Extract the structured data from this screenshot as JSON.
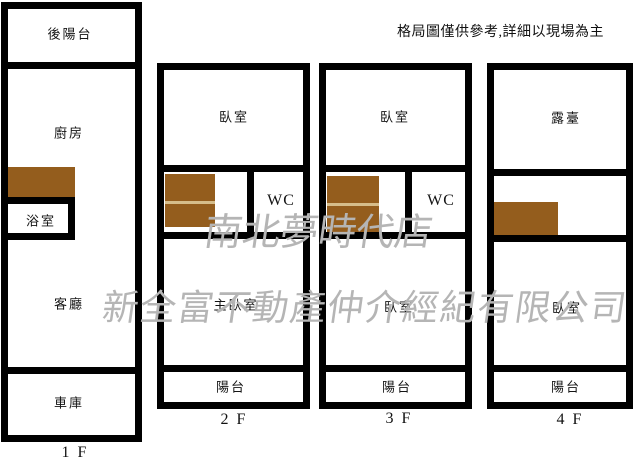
{
  "disclaimer": "格局圖僅供參考,詳細以現場為主",
  "watermark": {
    "line1": "南北夢時代店",
    "line2": "新全富不動產仲介經紀有限公司"
  },
  "colors": {
    "wall": "#000000",
    "background": "#ffffff",
    "furniture_brown": "#945d1d",
    "furniture_divider_line": "#d6bd8a",
    "watermark_gray": "#b5b5b5"
  },
  "plans": [
    {
      "floor_label": "1 F",
      "rooms": {
        "rear_balcony": "後陽台",
        "kitchen": "廚房",
        "bathroom": "浴室",
        "living_room": "客廳",
        "garage": "車庫"
      }
    },
    {
      "floor_label": "2 F",
      "rooms": {
        "bedroom": "臥室",
        "wc": "WC",
        "master_bedroom": "主臥室",
        "balcony": "陽台"
      }
    },
    {
      "floor_label": "3 F",
      "rooms": {
        "bedroom_upper": "臥室",
        "wc": "WC",
        "bedroom_lower": "臥室",
        "balcony": "陽台"
      }
    },
    {
      "floor_label": "4 F",
      "rooms": {
        "terrace": "露臺",
        "bedroom": "臥室",
        "balcony": "陽台"
      }
    }
  ]
}
